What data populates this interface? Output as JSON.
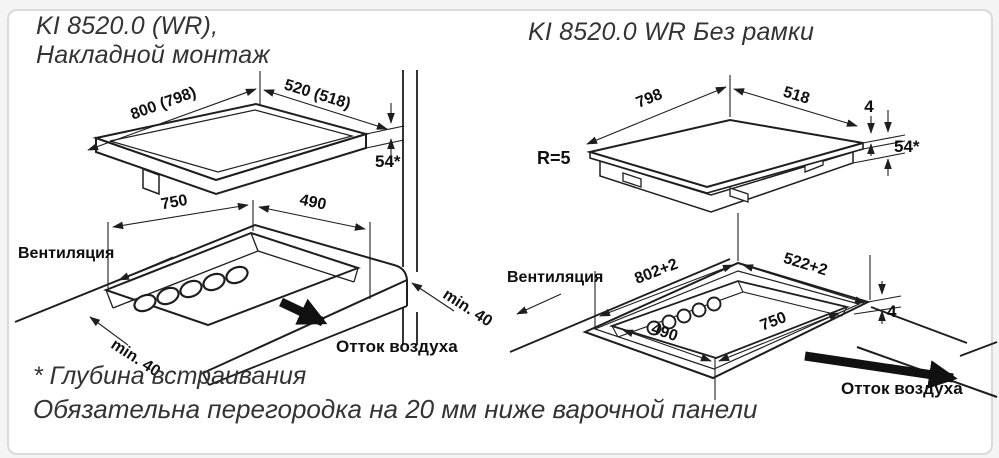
{
  "left_diagram": {
    "title_line1": "KI 8520.0 (WR),",
    "title_line2": "Накладной монтаж",
    "dims": {
      "width": "800 (798)",
      "depth": "520 (518)",
      "height": "54*",
      "cutout_width": "750",
      "cutout_depth": "490",
      "clearance_front": "min. 40",
      "clearance_wall": "min. 40"
    },
    "labels": {
      "ventilation": "Вентиляция",
      "air_outflow": "Отток воздуха"
    }
  },
  "right_diagram": {
    "title": "KI 8520.0 WR Без рамки",
    "dims": {
      "width": "798",
      "depth": "518",
      "glass_lip": "4",
      "height": "54*",
      "corner_radius": "R=5",
      "cutout_width": "802+2",
      "cutout_depth": "522+2",
      "step": "4",
      "inner_depth": "490",
      "inner_width": "750"
    },
    "labels": {
      "ventilation": "Вентиляция",
      "air_outflow": "Отток воздуха"
    }
  },
  "footnotes": {
    "line1": "* Глубина встраивания",
    "line2": "Обязательна перегородка на 20 мм ниже варочной панели"
  },
  "colors": {
    "line": "#1e1e1e",
    "text": "#0f0f0f",
    "title": "#333333",
    "card_border": "#d9d9d9",
    "background": "#ffffff"
  }
}
